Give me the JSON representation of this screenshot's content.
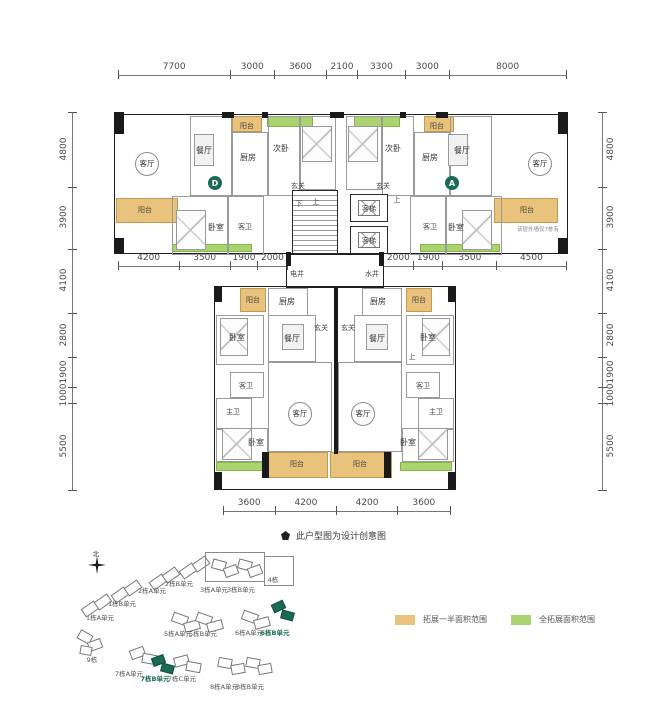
{
  "colors": {
    "half_extension": "#e9c37b",
    "full_extension": "#abd36f",
    "highlight": "#1b6a55",
    "wall": "#1a1a1a"
  },
  "note": {
    "text": "此户型图为设计创意图"
  },
  "legend": {
    "items": [
      {
        "label": "拓展一半面积范围",
        "color": "#e9c37b"
      },
      {
        "label": "全拓展面积范围",
        "color": "#abd36f"
      }
    ]
  },
  "dim_rows": [
    {
      "x": 118,
      "y": 61,
      "len": 448,
      "vert": false,
      "vals": [
        "7700",
        "3000",
        "3600",
        "2100",
        "3300",
        "3000",
        "8000"
      ]
    },
    {
      "x": 118,
      "y": 252,
      "len": 169,
      "vert": false,
      "vals": [
        "4200",
        "3500",
        "1900",
        "2000"
      ]
    },
    {
      "x": 383,
      "y": 252,
      "len": 183,
      "vert": false,
      "vals": [
        "2000",
        "1900",
        "3500",
        "4500"
      ]
    },
    {
      "x": 223,
      "y": 497,
      "len": 227,
      "vert": false,
      "vals": [
        "3600",
        "4200",
        "4200",
        "3600"
      ]
    },
    {
      "x": 64,
      "y": 112,
      "len": 378,
      "vert": true,
      "side": "left",
      "vals": [
        "4800",
        "3900",
        "4100",
        "2800",
        "1900",
        "1000",
        "5500"
      ]
    },
    {
      "x": 594,
      "y": 112,
      "len": 378,
      "vert": true,
      "side": "right",
      "vals": [
        "4800",
        "3900",
        "4100",
        "2800",
        "1900",
        "1000",
        "5500"
      ]
    }
  ],
  "plan": {
    "rects": [
      [
        "out",
        114,
        114,
        454,
        140
      ],
      [
        "out",
        214,
        286,
        242,
        204
      ],
      [
        "out",
        286,
        254,
        98,
        34
      ],
      [
        "half",
        232,
        116,
        30,
        16
      ],
      [
        "half",
        424,
        116,
        30,
        16
      ],
      [
        "half",
        116,
        198,
        62,
        25
      ],
      [
        "half",
        494,
        198,
        64,
        25
      ],
      [
        "half",
        240,
        288,
        26,
        24
      ],
      [
        "half",
        406,
        288,
        26,
        24
      ],
      [
        "half",
        266,
        452,
        62,
        26
      ],
      [
        "half",
        330,
        452,
        62,
        26
      ],
      [
        "full",
        267,
        116,
        46,
        11
      ],
      [
        "full",
        354,
        116,
        46,
        11
      ],
      [
        "full",
        172,
        244,
        80,
        8
      ],
      [
        "full",
        420,
        244,
        80,
        8
      ],
      [
        "full",
        216,
        462,
        52,
        9
      ],
      [
        "full",
        400,
        462,
        52,
        9
      ],
      [
        "room",
        190,
        116,
        42,
        80
      ],
      [
        "room",
        232,
        132,
        36,
        64
      ],
      [
        "room",
        268,
        116,
        32,
        80
      ],
      [
        "room",
        300,
        116,
        36,
        74
      ],
      [
        "room",
        450,
        116,
        42,
        80
      ],
      [
        "room",
        414,
        132,
        36,
        64
      ],
      [
        "room",
        382,
        116,
        32,
        80
      ],
      [
        "room",
        346,
        116,
        36,
        74
      ],
      [
        "room",
        172,
        196,
        56,
        59
      ],
      [
        "room",
        228,
        196,
        36,
        59
      ],
      [
        "room",
        446,
        196,
        56,
        59
      ],
      [
        "room",
        410,
        196,
        36,
        59
      ],
      [
        "room",
        268,
        288,
        40,
        28
      ],
      [
        "room",
        362,
        288,
        40,
        28
      ],
      [
        "room",
        216,
        315,
        48,
        50
      ],
      [
        "room",
        406,
        315,
        48,
        50
      ],
      [
        "room",
        268,
        315,
        48,
        47
      ],
      [
        "room",
        354,
        315,
        48,
        47
      ],
      [
        "room",
        230,
        372,
        34,
        26
      ],
      [
        "room",
        406,
        372,
        34,
        26
      ],
      [
        "room",
        216,
        398,
        36,
        32
      ],
      [
        "room",
        418,
        398,
        36,
        32
      ],
      [
        "room",
        268,
        362,
        64,
        90
      ],
      [
        "room",
        338,
        362,
        64,
        90
      ],
      [
        "room",
        216,
        428,
        52,
        34
      ],
      [
        "room",
        402,
        428,
        52,
        34
      ],
      [
        "stair",
        292,
        190,
        46,
        64
      ],
      [
        "lift",
        350,
        194,
        38,
        28
      ],
      [
        "lift",
        350,
        226,
        38,
        28
      ],
      [
        "liftin",
        358,
        200,
        22,
        16
      ],
      [
        "liftin",
        358,
        232,
        22,
        16
      ],
      [
        "bed",
        302,
        126,
        30,
        36
      ],
      [
        "bed",
        348,
        126,
        30,
        36
      ],
      [
        "bed",
        176,
        210,
        30,
        40
      ],
      [
        "bed",
        462,
        210,
        30,
        40
      ],
      [
        "bed",
        220,
        318,
        28,
        38
      ],
      [
        "bed",
        422,
        318,
        28,
        38
      ],
      [
        "bed",
        222,
        428,
        30,
        32
      ],
      [
        "bed",
        418,
        428,
        30,
        32
      ],
      [
        "table",
        194,
        134,
        20,
        32
      ],
      [
        "table",
        448,
        134,
        20,
        32
      ],
      [
        "table",
        282,
        324,
        22,
        26
      ],
      [
        "table",
        366,
        324,
        22,
        26
      ],
      [
        "wall",
        114,
        112,
        10,
        22
      ],
      [
        "wall",
        558,
        112,
        10,
        22
      ],
      [
        "wall",
        114,
        238,
        10,
        16
      ],
      [
        "wall",
        558,
        238,
        10,
        16
      ],
      [
        "wall",
        222,
        112,
        12,
        6
      ],
      [
        "wall",
        262,
        112,
        6,
        6
      ],
      [
        "wall",
        330,
        112,
        14,
        6
      ],
      [
        "wall",
        400,
        112,
        6,
        6
      ],
      [
        "wall",
        436,
        112,
        12,
        6
      ],
      [
        "wall",
        214,
        286,
        8,
        16
      ],
      [
        "wall",
        448,
        286,
        8,
        16
      ],
      [
        "wall",
        214,
        472,
        8,
        18
      ],
      [
        "wall",
        448,
        472,
        8,
        18
      ],
      [
        "wall",
        262,
        452,
        7,
        26
      ],
      [
        "wall",
        384,
        452,
        7,
        26
      ],
      [
        "wall",
        334,
        288,
        4,
        166
      ],
      [
        "wall",
        286,
        252,
        5,
        14
      ],
      [
        "wall",
        379,
        252,
        5,
        14
      ]
    ],
    "labels": [
      [
        "客厅",
        147,
        164,
        "circ"
      ],
      [
        "餐厅",
        204,
        151,
        ""
      ],
      [
        "阳台",
        247,
        126,
        "s"
      ],
      [
        "厨房",
        248,
        158,
        ""
      ],
      [
        "次卧",
        281,
        149,
        ""
      ],
      [
        "玄关",
        298,
        186,
        "s"
      ],
      [
        "下",
        299,
        204,
        "s"
      ],
      [
        "上",
        316,
        202,
        "s"
      ],
      [
        "玄关",
        383,
        186,
        "s"
      ],
      [
        "上",
        397,
        200,
        "s"
      ],
      [
        "次卧",
        393,
        149,
        ""
      ],
      [
        "厨房",
        430,
        158,
        ""
      ],
      [
        "餐厅",
        462,
        151,
        ""
      ],
      [
        "阳台",
        437,
        126,
        "s"
      ],
      [
        "客厅",
        540,
        164,
        "circ"
      ],
      [
        "阳台",
        145,
        210,
        "s"
      ],
      [
        "卧室",
        216,
        228,
        ""
      ],
      [
        "客卫",
        245,
        227,
        "s"
      ],
      [
        "客梯",
        369,
        209,
        "s"
      ],
      [
        "客梯",
        369,
        241,
        "s"
      ],
      [
        "卧室",
        456,
        228,
        ""
      ],
      [
        "客卫",
        430,
        227,
        "s"
      ],
      [
        "阳台",
        527,
        210,
        "s"
      ],
      [
        "电井",
        297,
        274,
        "s"
      ],
      [
        "水井",
        372,
        274,
        "s"
      ],
      [
        "该层外墙仅7栋有",
        538,
        232,
        "tiny"
      ],
      [
        "阳台",
        253,
        300,
        "s"
      ],
      [
        "厨房",
        287,
        302,
        ""
      ],
      [
        "阳台",
        419,
        300,
        "s"
      ],
      [
        "厨房",
        378,
        302,
        ""
      ],
      [
        "玄关",
        321,
        328,
        "s"
      ],
      [
        "玄关",
        348,
        328,
        "s"
      ],
      [
        "餐厅",
        292,
        339,
        ""
      ],
      [
        "餐厅",
        377,
        339,
        ""
      ],
      [
        "卧室",
        237,
        338,
        ""
      ],
      [
        "卧室",
        428,
        338,
        ""
      ],
      [
        "上",
        412,
        357,
        "s"
      ],
      [
        "客卫",
        246,
        386,
        "s"
      ],
      [
        "客卫",
        423,
        386,
        "s"
      ],
      [
        "主卫",
        233,
        412,
        "s"
      ],
      [
        "主卫",
        436,
        412,
        "s"
      ],
      [
        "客厅",
        300,
        414,
        "circ"
      ],
      [
        "客厅",
        363,
        414,
        "circ"
      ],
      [
        "卧室",
        256,
        443,
        ""
      ],
      [
        "卧室",
        408,
        443,
        ""
      ],
      [
        "阳台",
        297,
        464,
        "s"
      ],
      [
        "阳台",
        360,
        464,
        "s"
      ]
    ],
    "badges": [
      [
        "D",
        215,
        183
      ],
      [
        "A",
        452,
        183
      ]
    ]
  },
  "site_plan": {
    "north_label": "北",
    "blocks": [
      [
        82,
        604,
        16,
        10,
        -35,
        0
      ],
      [
        95,
        597,
        16,
        10,
        -35,
        0
      ],
      [
        112,
        590,
        16,
        10,
        -35,
        0
      ],
      [
        125,
        583,
        16,
        10,
        -35,
        0
      ],
      [
        150,
        577,
        16,
        10,
        -35,
        0
      ],
      [
        163,
        570,
        16,
        10,
        -35,
        0
      ],
      [
        180,
        566,
        16,
        10,
        -35,
        0
      ],
      [
        193,
        559,
        16,
        10,
        -35,
        0
      ],
      [
        212,
        560,
        14,
        10,
        15,
        0
      ],
      [
        224,
        566,
        14,
        10,
        -20,
        0
      ],
      [
        238,
        560,
        14,
        10,
        15,
        0
      ],
      [
        248,
        566,
        14,
        10,
        -20,
        0
      ],
      [
        172,
        614,
        16,
        10,
        20,
        0
      ],
      [
        184,
        621,
        16,
        10,
        -15,
        0
      ],
      [
        196,
        614,
        16,
        10,
        20,
        0
      ],
      [
        207,
        621,
        16,
        10,
        -15,
        0
      ],
      [
        242,
        612,
        16,
        10,
        20,
        0
      ],
      [
        254,
        618,
        16,
        10,
        -15,
        0
      ],
      [
        272,
        602,
        13,
        9,
        -25,
        1
      ],
      [
        281,
        611,
        13,
        9,
        15,
        1
      ],
      [
        78,
        632,
        14,
        10,
        30,
        0
      ],
      [
        88,
        640,
        14,
        10,
        -20,
        0
      ],
      [
        80,
        646,
        12,
        9,
        10,
        0
      ],
      [
        130,
        648,
        15,
        10,
        -20,
        0
      ],
      [
        142,
        654,
        15,
        10,
        10,
        0
      ],
      [
        152,
        656,
        13,
        9,
        -20,
        1
      ],
      [
        161,
        664,
        13,
        9,
        15,
        1
      ],
      [
        174,
        656,
        15,
        10,
        -15,
        0
      ],
      [
        186,
        662,
        15,
        10,
        10,
        0
      ],
      [
        218,
        658,
        14,
        10,
        10,
        0
      ],
      [
        231,
        664,
        14,
        10,
        -10,
        0
      ],
      [
        246,
        658,
        14,
        10,
        10,
        0
      ],
      [
        258,
        664,
        14,
        10,
        -10,
        0
      ]
    ],
    "boxes": [
      [
        205,
        552,
        60,
        30
      ],
      [
        264,
        556,
        30,
        30
      ]
    ],
    "labels": [
      [
        "1栋A单元",
        100,
        616,
        0
      ],
      [
        "1栋B单元",
        122,
        602,
        0
      ],
      [
        "2栋A单元",
        152,
        589,
        0
      ],
      [
        "2栋B单元",
        179,
        582,
        0
      ],
      [
        "3栋A单元",
        214,
        588,
        0
      ],
      [
        "3栋B单元",
        241,
        588,
        0
      ],
      [
        "4栋",
        273,
        578,
        0
      ],
      [
        "5栋A单元",
        178,
        632,
        0
      ],
      [
        "5栋B单元",
        203,
        632,
        0
      ],
      [
        "6栋A单元",
        249,
        631,
        0
      ],
      [
        "6栋B单元",
        275,
        631,
        1
      ],
      [
        "9栋",
        92,
        658,
        0
      ],
      [
        "7栋A单元",
        129,
        672,
        0
      ],
      [
        "7栋B单元",
        155,
        677,
        1
      ],
      [
        "7栋C单元",
        182,
        677,
        0
      ],
      [
        "8栋A单元",
        224,
        685,
        0
      ],
      [
        "8栋B单元",
        250,
        685,
        0
      ]
    ]
  }
}
